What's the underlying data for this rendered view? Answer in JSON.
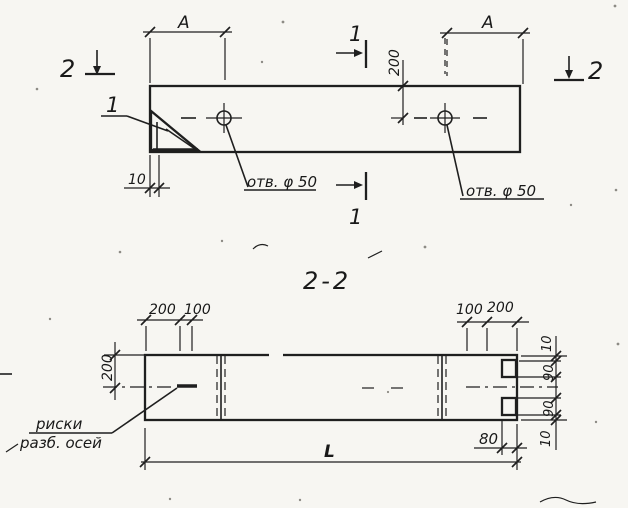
{
  "meta": {
    "paper_color": "#f7f6f2",
    "ink_color": "#1f1f1f"
  },
  "top_view": {
    "span_label_left": "A",
    "span_label_right": "A",
    "hole_offset_200": "200",
    "edge_offset_10": "10",
    "hole_label_left": "отв. φ 50",
    "hole_label_right": "отв. φ 50",
    "section_marker_2_left": "2",
    "section_marker_2_right": "2",
    "section_marker_1_top": "1",
    "section_marker_1_bottom": "1",
    "detail_callout_1": "1"
  },
  "section_view": {
    "title": "2-2",
    "dims_top_left": [
      "200",
      "100"
    ],
    "dims_top_right": [
      "100",
      "200"
    ],
    "height_200": "200",
    "dims_right": [
      "10",
      "90",
      "90",
      "10"
    ],
    "notch_offset_80": "80",
    "length_label": "L",
    "axis_label_line1": "риски",
    "axis_label_line2": "разб. осей"
  }
}
